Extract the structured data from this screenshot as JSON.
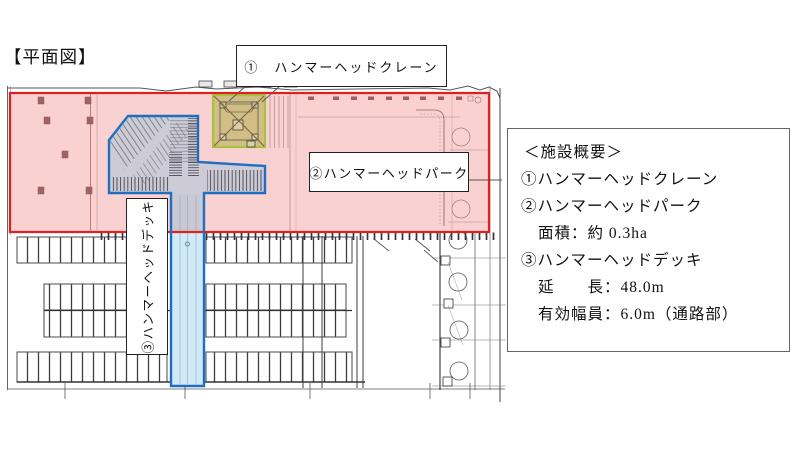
{
  "page": {
    "title": "【平面図】"
  },
  "plan_labels": {
    "crane": "①　ハンマーヘッドクレーン",
    "park": "②ハンマーヘッドパーク",
    "deck": "③ハンマーヘッドデッキ"
  },
  "overview": {
    "heading": "＜施設概要＞",
    "lines": [
      {
        "text": "①ハンマーヘッドクレーン"
      },
      {
        "text": "②ハンマーヘッドパーク"
      },
      {
        "text": "面積：約 0.3ha"
      },
      {
        "text": "③ハンマーヘッドデッキ"
      },
      {
        "text": "延　　長：48.0m"
      },
      {
        "text": "有効幅員：6.0m（通路部）"
      }
    ]
  },
  "legend_colors": {
    "park_area_border": "#e21f1f",
    "park_area_fill": "#f6cccc",
    "crane_footprint_border": "#a6c23f",
    "crane_footprint_fill": "#cfc08d",
    "deck_border": "#1e6ec2",
    "deck_fill": "#cfe9f6"
  }
}
